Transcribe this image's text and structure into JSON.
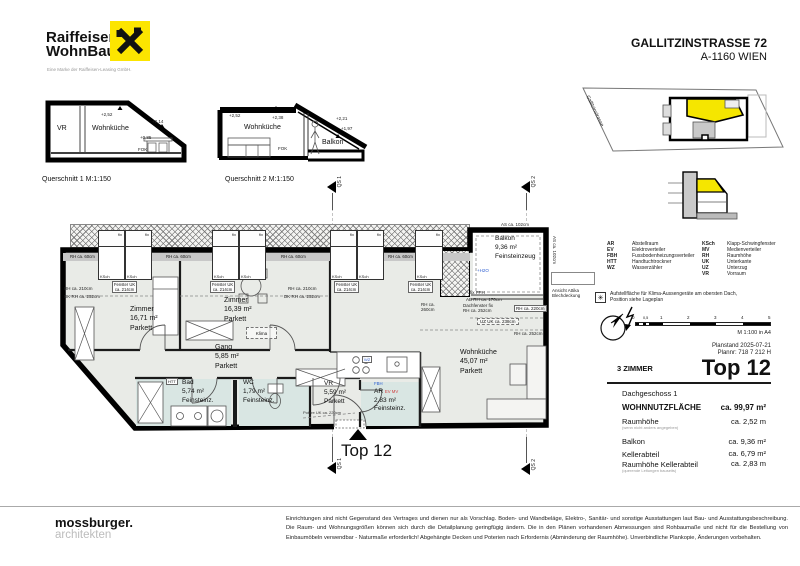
{
  "brand": {
    "n1": "Raiffeisen",
    "n2": "WohnBau",
    "tag": "Eine Marke der Raiffeisen-Leasing GmbH."
  },
  "head": {
    "t1": "GALLITZINSTRASSE 72",
    "t2": "A-1160 WIEN"
  },
  "qs1": {
    "caption": "Querschnitt 1 M:1:150",
    "room1": "VR",
    "room2": "Wohnküche",
    "l1": "+2,52",
    "l2": "+2,14",
    "l3": "+0,85",
    "l4": "FOK"
  },
  "qs2": {
    "caption": "Querschnitt 2 M:1:150",
    "room1": "Wohnküche",
    "room2": "Balkon",
    "l1": "+2,52",
    "l2": "+2,38",
    "l3": "+2,21",
    "l4": "+1,97",
    "l5": "FOK"
  },
  "site": {
    "street": "Gallitzinstrasse"
  },
  "legend": {
    "left": [
      {
        "a": "AR",
        "t": "Abstellraum"
      },
      {
        "a": "EV",
        "t": "Elektroverteiler"
      },
      {
        "a": "FBH",
        "t": "Fussbodenheizungsverteiler"
      },
      {
        "a": "HTT",
        "t": "Handtuchtrockner"
      },
      {
        "a": "WZ",
        "t": "Wasserzähler"
      }
    ],
    "right": [
      {
        "a": "KSch",
        "t": "Klapp-Schwingfenster"
      },
      {
        "a": "MV",
        "t": "Medienverteiler"
      },
      {
        "a": "RH",
        "t": "Raumhöhe"
      },
      {
        "a": "UK",
        "t": "Unterkante"
      },
      {
        "a": "UZ",
        "t": "Unterzug"
      },
      {
        "a": "VR",
        "t": "Vorraum"
      }
    ]
  },
  "climate": {
    "note1": "Aufstellfläche für Klima-Aussengeräte am obersten Dach,",
    "note2": "Position siehe Lageplan"
  },
  "scale": {
    "ticks": [
      "0",
      "0,5",
      "1",
      "2",
      "3",
      "4",
      "5"
    ],
    "note": "M 1:100 in A4"
  },
  "meta": {
    "planstand": "Planstand 2025-07-21",
    "plannr": "Plannr: 718 7 212 H",
    "zimmer": "3 ZIMMER",
    "top": "Top 12"
  },
  "info": {
    "floor": "Dachgeschoss 1",
    "r1l": "WOHNNUTZFLÄCHE",
    "r1v": "ca. 99,97 m²",
    "r2l": "Raumhöhe",
    "r2n": "(wenn nicht anders angegeben)",
    "r2v": "ca. 2,52 m",
    "r3l": "Balkon",
    "r3v": "ca. 9,36 m²",
    "r4l": "Kellerabteil",
    "r4v": "ca. 6,79 m²",
    "r5l": "Raumhöhe Kellerabteil",
    "r5n": "(querende Leitungen bauseits)",
    "r5v": "ca. 2,83 m"
  },
  "plan": {
    "entrance": "Top 12",
    "qs1": "QS 1",
    "qs2": "QS 2",
    "rooms": {
      "z1": {
        "n": "Zimmer",
        "a": "16,71 m²",
        "f": "Parkett"
      },
      "z2": {
        "n": "Zimmer",
        "a": "16,39 m²",
        "f": "Parkett"
      },
      "gang": {
        "n": "Gang",
        "a": "5,85 m²",
        "f": "Parkett"
      },
      "bad": {
        "n": "Bad",
        "a": "5,74 m²",
        "f": "Feinsteinz."
      },
      "wc": {
        "n": "WC",
        "a": "1,79 m²",
        "f": "Feinsteinz."
      },
      "vr": {
        "n": "VR",
        "a": "5,59 m²",
        "f": "Parkett"
      },
      "ar": {
        "n": "AR",
        "a": "2,83 m²",
        "f": "Feinsteinz."
      },
      "wk": {
        "n": "Wohnküche",
        "a": "45,07 m²",
        "f": "Parkett"
      },
      "balkon": {
        "n": "Balkon",
        "a": "9,36 m²",
        "f": "Feinsteinzeug"
      }
    },
    "ann": {
      "fix": "fix",
      "ksch": "KSch",
      "rh60": "RH ca. 60cm",
      "fuk1": "Fenster UK",
      "fuk2": "ca. 214cm",
      "rh210": "RH ca. 210cm",
      "dkrh252": "DK RH ca. 252cm",
      "as102": "AS ca. 102cm",
      "h2o": "+H2O",
      "klima": "Klima",
      "fixfph": "fix FPH",
      "abrh170": "AB RH ca. 170cm",
      "dfix1": "Dachfenster fix",
      "dfix2": "RH ca. 252cm",
      "rh220": "RH ca. 220cm",
      "uzuk": "UZ UK ca. 238cm",
      "rh252": "RH ca. 252cm",
      "rh260a": "RH ca.",
      "rh260b": "260cm",
      "attika1": "Ansicht Attika",
      "attika2": "Blechdeckung",
      "potere": "Potere UK ca. 220cm",
      "htt": "HTT",
      "wz": "WZ",
      "fbh": "FBH",
      "evmv": "EV MV"
    }
  },
  "footer": {
    "studio1": "mossburger.",
    "studio2": "architekten",
    "disclaimer": "Einrichtungen sind nicht Gegenstand des Vertrages und dienen nur als Vorschlag. Boden- und Wandbeläge, Elektro-, Sanitär- und sonstige Ausstattungen laut Bau- und Ausstattungsbeschreibung. Die Raum- und Wohnungsgrößen können sich durch die Detailplanung geringfügig ändern. Die in den Plänen vorhandenen Abmessungen sind Rohbaumaße und nicht für die Bestellung von Einbaumöbeln verwendbar - Naturmaße erforderlich! Abgehängte Decken und Poterien nach Erfordernis (Abminderung der Raumhöhe). Unverbindliche Plankopie, Änderungen vorbehalten."
  }
}
